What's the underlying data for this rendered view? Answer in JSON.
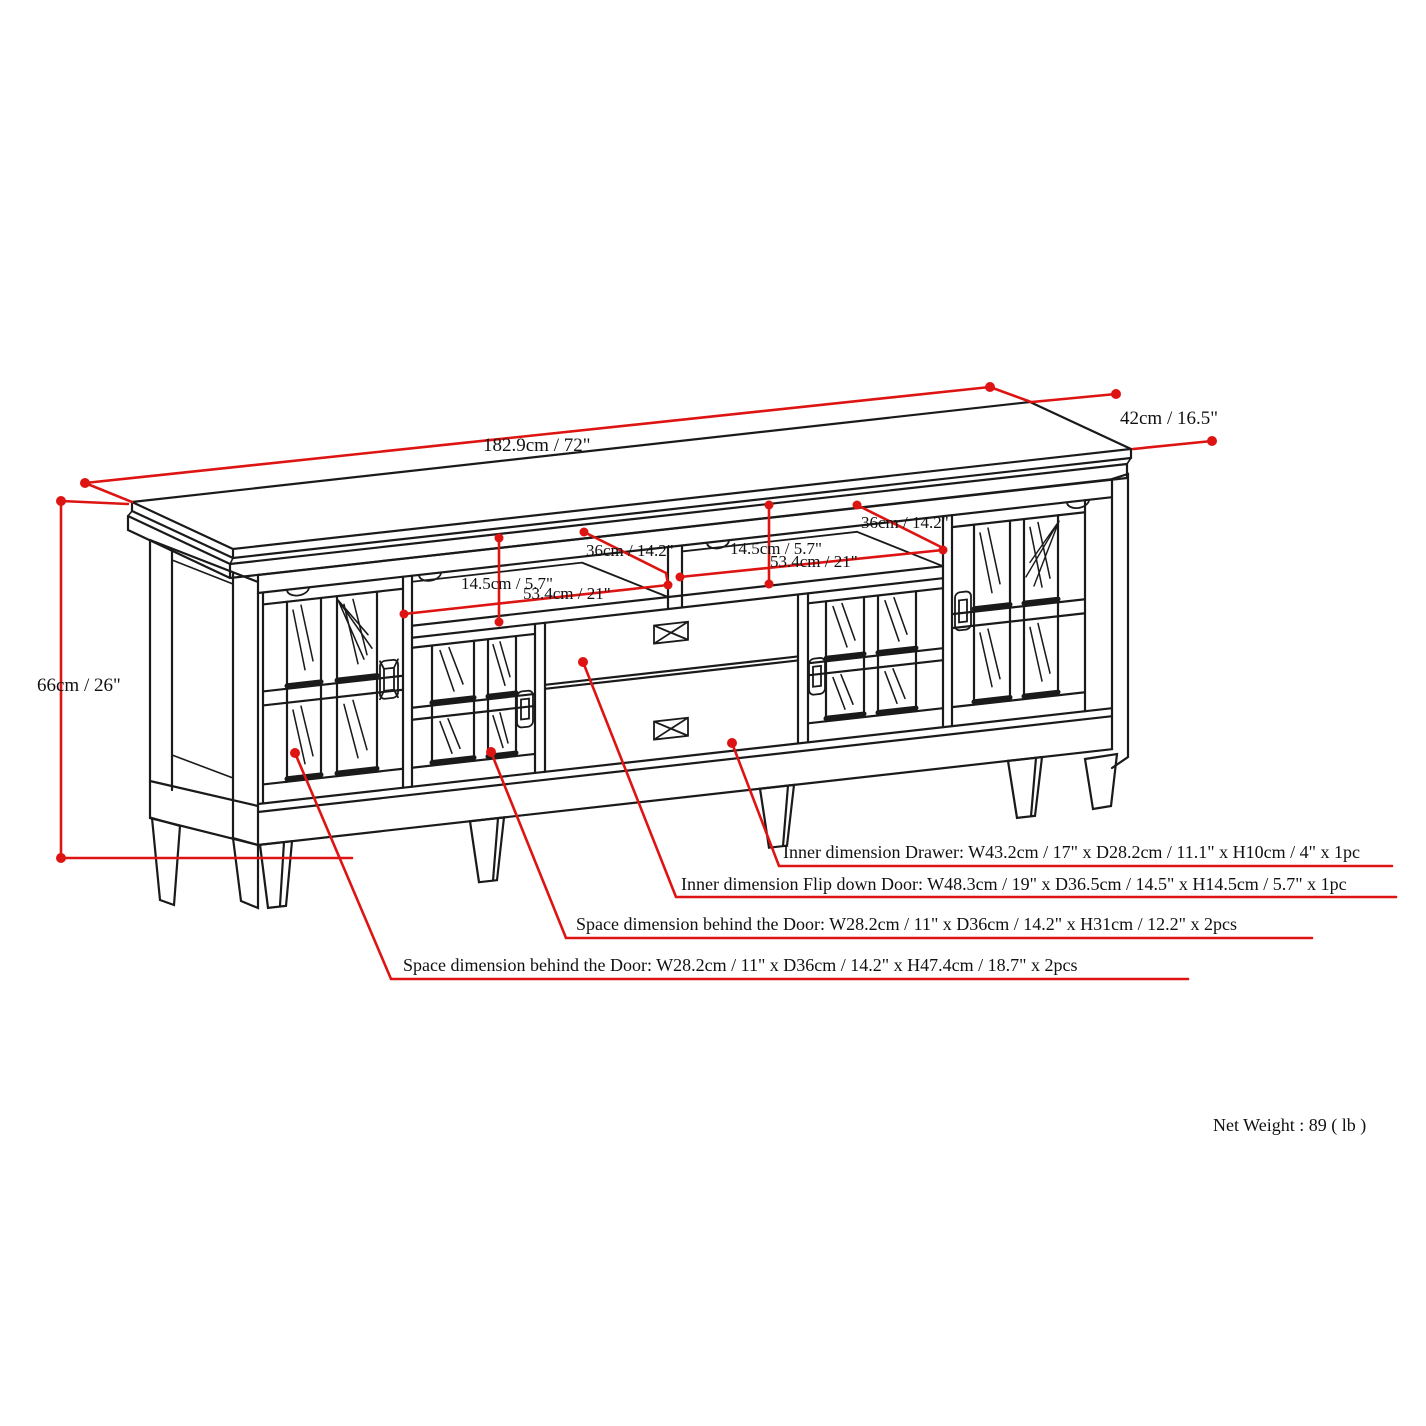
{
  "diagram": {
    "title": "TV stand technical dimension drawing",
    "colors": {
      "line": "#1a1a1a",
      "dimension_red": "#dd1412",
      "background": "#ffffff"
    },
    "overall": {
      "width_label": "182.9cm / 72\"",
      "depth_label": "42cm / 16.5\"",
      "height_label": "66cm / 26\""
    },
    "shelf_left": {
      "height_label": "14.5cm / 5.7\"",
      "width_label": "53.4cm / 21\"",
      "depth_label": "36cm / 14.2\""
    },
    "shelf_right": {
      "height_label": "14.5cm / 5.7\"",
      "width_label": "53.4cm / 21\"",
      "depth_label": "36cm / 14.2\""
    },
    "annotations": {
      "drawer": "Inner dimension Drawer: W43.2cm / 17\" x D28.2cm / 11.1\" x H10cm / 4\" x 1pc",
      "flip_door": "Inner dimension Flip down Door: W48.3cm / 19\" x D36.5cm / 14.5\" x H14.5cm / 5.7\" x 1pc",
      "space_small_door": "Space dimension behind the Door: W28.2cm / 11\" x D36cm / 14.2\" x H31cm / 12.2\" x 2pcs",
      "space_tall_door": "Space dimension behind the Door:  W28.2cm / 11\" x D36cm / 14.2\" x H47.4cm / 18.7\" x 2pcs"
    },
    "net_weight": "Net Weight : 89 ( lb )"
  }
}
